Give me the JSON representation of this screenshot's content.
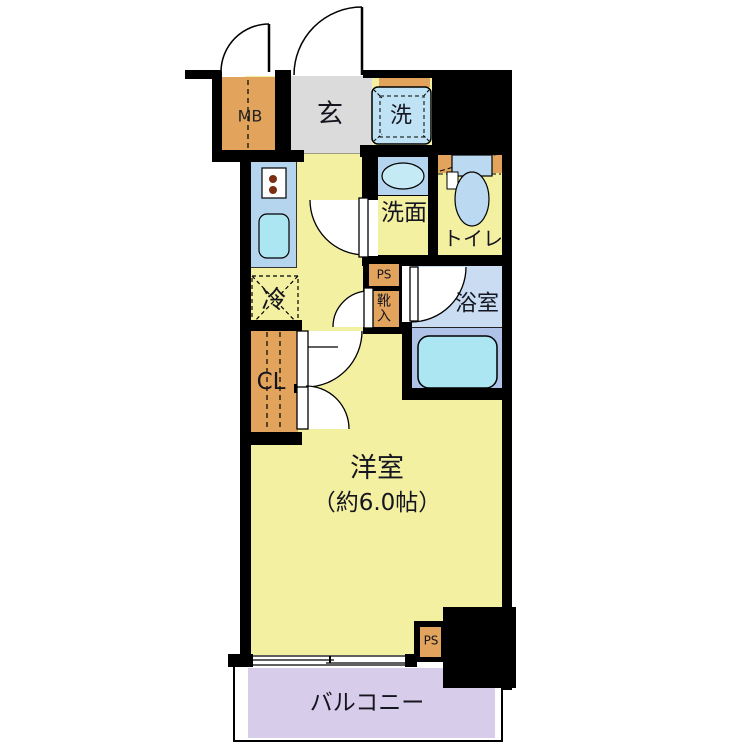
{
  "title": "1K apartment floor plan",
  "rooms": {
    "mb": "MB",
    "genkan": "玄",
    "washer": "洗",
    "senmen": "洗面",
    "toilet": "トイレ",
    "fridge": "冷",
    "ps_upper": "PS",
    "shoe_box": "靴入",
    "bathroom": "浴室",
    "closet": "CL",
    "western_room": "洋室",
    "western_room_size": "（約6.0帖）",
    "ps_lower": "PS",
    "balcony": "バルコニー"
  },
  "colors": {
    "wall": "#000000",
    "floor_yellow": "#F4F0A2",
    "entrance_gray": "#DBDBDB",
    "storage_orange": "#E2A45C",
    "counter_blue": "#B5D4EE",
    "fixture_cyan": "#ABE6F2",
    "washer_blue": "#BFE2F4",
    "bath_upper_blue": "#C9DCF2",
    "bath_lower_blue": "#AFC3E8",
    "balcony_lavender": "#D7CDEB"
  }
}
